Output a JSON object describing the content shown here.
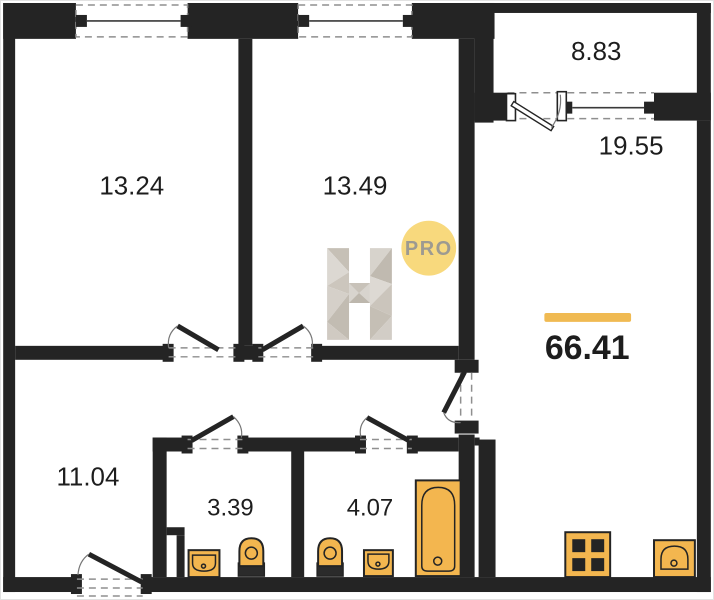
{
  "plan": {
    "rooms": {
      "room_top_left": {
        "area": "13.24"
      },
      "room_top_middle": {
        "area": "13.49"
      },
      "balcony": {
        "area": "8.83"
      },
      "kitchen_living": {
        "area": "19.55"
      },
      "hallway": {
        "area": "11.04"
      },
      "wc": {
        "area": "3.39"
      },
      "bathroom": {
        "area": "4.07"
      }
    },
    "total_area": "66.41",
    "watermark": {
      "letter": "H",
      "badge": "PRO"
    },
    "fixtures": [
      "sink",
      "toilet",
      "bathtub",
      "stove",
      "kitchen-sink"
    ],
    "colors": {
      "wall": "#242424",
      "accent_bar": "#F0BA52",
      "fixture": "#F3B64F",
      "badge_bg": "#F8D97D",
      "badge_text": "#9D9A91",
      "dash": "#8F8F8F"
    }
  }
}
